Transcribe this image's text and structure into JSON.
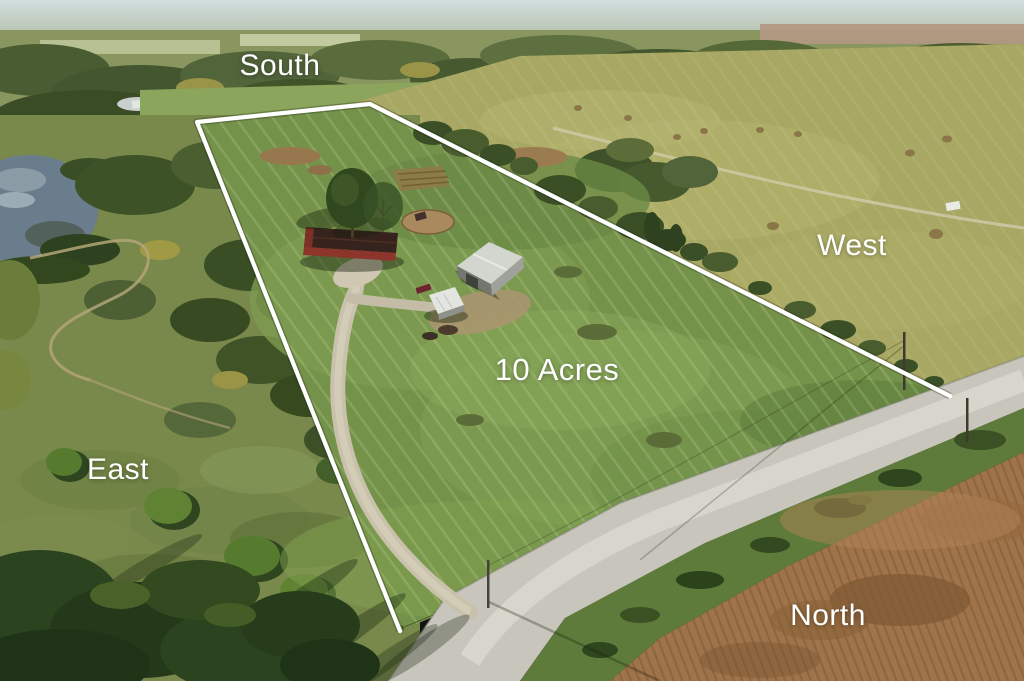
{
  "overlay": {
    "compass": {
      "south": {
        "label": "South"
      },
      "west": {
        "label": "West"
      },
      "east": {
        "label": "East"
      },
      "north": {
        "label": "North"
      }
    },
    "acreage_label": "10 Acres"
  },
  "palette": {
    "labelText": "#ffffff",
    "boundary": "#ffffff",
    "pastureGreen": "#74924a",
    "westField": "#a8a763",
    "eastScrub": "#79894c",
    "roadGray": "#c8c6bc",
    "cropBrown": "#a0744a",
    "waterBlue": "#6a7d8c",
    "treeDark": "#3a4f26",
    "houseRed": "#8e352b",
    "barnGray": "#d3d6cf"
  }
}
